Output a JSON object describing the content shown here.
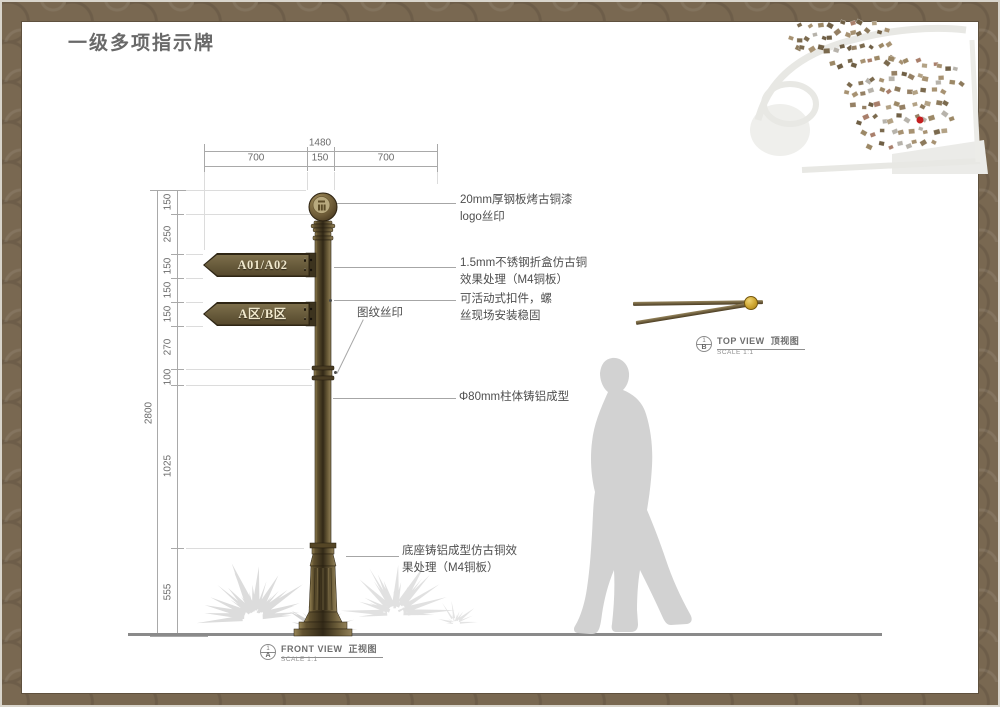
{
  "page": {
    "title": "一级多项指示牌"
  },
  "dimensions": {
    "top": {
      "total": "1480",
      "seg1": "700",
      "seg2": "150",
      "seg3": "700"
    },
    "left": {
      "overall": "2800",
      "segments": [
        "150",
        "250",
        "150",
        "150",
        "150",
        "270",
        "100",
        "1025",
        "555"
      ]
    }
  },
  "plates": {
    "plate1": "A01/A02",
    "plate2": "A区/B区"
  },
  "annotations": {
    "a1": [
      "20mm厚钢板烤古铜漆",
      "logo丝印"
    ],
    "a2": [
      "1.5mm不锈钢折盒仿古铜",
      "效果处理（M4铜板）"
    ],
    "a3": [
      "可活动式扣件，螺",
      "丝现场安装稳固"
    ],
    "a4": [
      "图纹丝印"
    ],
    "a5": [
      "Φ80mm柱体铸铝成型"
    ],
    "a6": [
      "底座铸铝成型仿古铜效",
      "果处理（M4铜板）"
    ]
  },
  "views": {
    "top": {
      "en": "TOP VIEW",
      "zh": "顶视图",
      "scale": "SCALE 1:1",
      "num": "1",
      "sheet": "B"
    },
    "front": {
      "en": "FRONT VIEW",
      "zh": "正视图",
      "scale": "SCALE 1:1",
      "num": "1",
      "sheet": "A"
    }
  },
  "colors": {
    "frame": "#796851",
    "bronze": "#6a5c3c",
    "plate_text": "#f1e9cd",
    "gold_knob": "#cda42f",
    "marker_red": "#c41f1f",
    "silhouette": "#d2d2d2"
  }
}
